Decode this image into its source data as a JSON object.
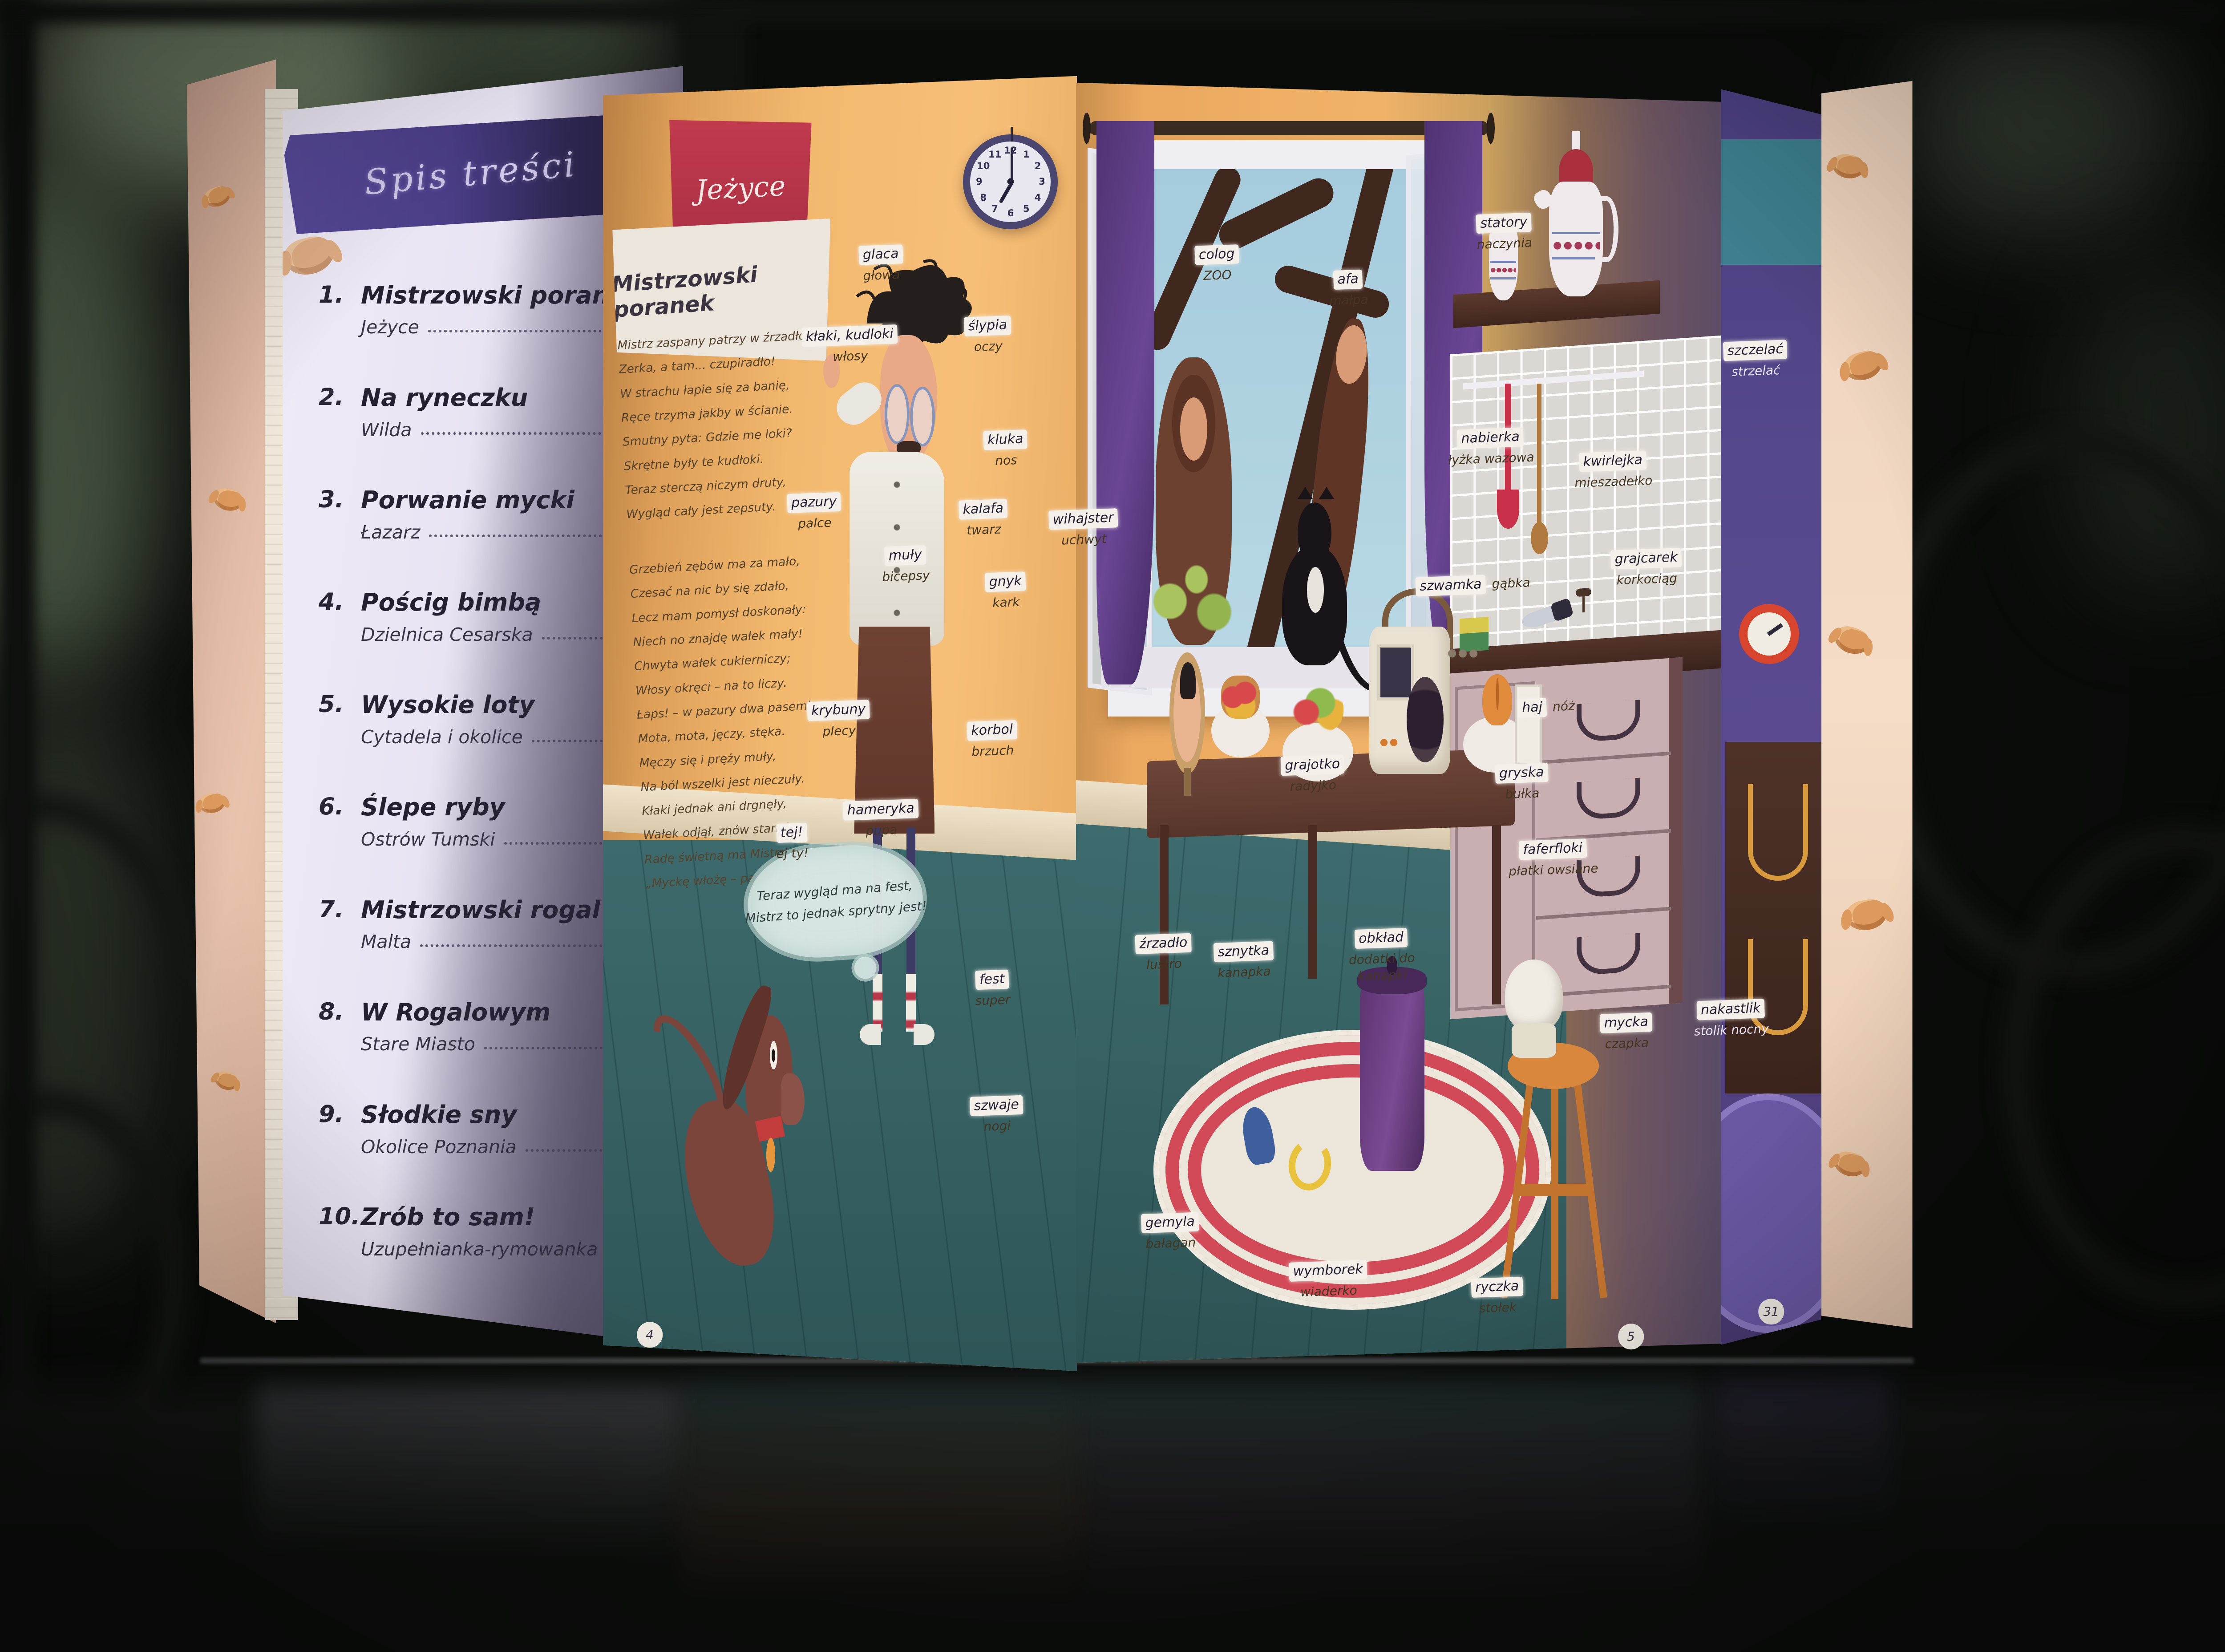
{
  "book": {
    "left_page": {
      "header": "Spis treści",
      "items": [
        {
          "num": "1.",
          "title": "Mistrzowski poranek",
          "sub": "Jeżyce"
        },
        {
          "num": "2.",
          "title": "Na ryneczku",
          "sub": "Wilda"
        },
        {
          "num": "3.",
          "title": "Porwanie mycki",
          "sub": "Łazarz"
        },
        {
          "num": "4.",
          "title": "Pościg bimbą",
          "sub": "Dzielnica Cesarska"
        },
        {
          "num": "5.",
          "title": "Wysokie loty",
          "sub": "Cytadela i okolice"
        },
        {
          "num": "6.",
          "title": "Ślepe ryby",
          "sub": "Ostrów Tumski"
        },
        {
          "num": "7.",
          "title": "Mistrzowski rogal",
          "sub": "Malta"
        },
        {
          "num": "8.",
          "title": "W Rogalowym",
          "sub": "Stare Miasto"
        },
        {
          "num": "9.",
          "title": "Słodkie sny",
          "sub": "Okolice Poznania"
        },
        {
          "num": "10.",
          "title": "Zrób to sam!",
          "sub": "Uzupełnianka-rymowanka"
        }
      ]
    },
    "middle_page": {
      "district_tab": "Jeżyce",
      "chapter_title": "Mistrzowski poranek",
      "page_number": "4",
      "poem": [
        "Mistrz zaspany patrzy w źrzadło,",
        "Zerka, a tam... czupiradło!",
        "W strachu łapie się za banię,",
        "Ręce trzyma jakby w ścianie.",
        "Smutny pyta: Gdzie me loki?",
        "Skrętne były te kudłoki.",
        "Teraz sterczą niczym druty,",
        "Wygląd cały jest zepsuty.",
        "Grzebień zębów ma za mało,",
        "Czesać na nic by się zdało,",
        "Lecz mam pomysł doskonały:",
        "Niech no znajdę wałek mały!",
        "Chwyta wałek cukierniczy;",
        "Włosy okręci – na to liczy.",
        "Łaps! – w pazury dwa pasemka,",
        "Mota, mota, jęczy, stęka.",
        "Męczy się i pręży muły,",
        "Na ból wszelki jest nieczuły.",
        "Kłaki jednak ani drgnęły,",
        "Wałek odjął, znów stanęły...",
        "Radę świetną ma Mistrz za to:",
        "„Myckę włożę – pa, tej, na to!”"
      ],
      "speech_bubble": [
        "Teraz wygląd ma na fest,",
        "Mistrz to jednak sprytny jest!"
      ],
      "labels": [
        {
          "d": "glaca",
          "s": "głowa",
          "x": 39.6,
          "y": 16.0
        },
        {
          "d": "kłaki, kudloki",
          "s": "włosy",
          "x": 38.2,
          "y": 20.9
        },
        {
          "d": "ślypia",
          "s": "oczy",
          "x": 44.4,
          "y": 20.3
        },
        {
          "d": "kluka",
          "s": "nos",
          "x": 45.2,
          "y": 27.2
        },
        {
          "d": "pazury",
          "s": "palce",
          "x": 36.6,
          "y": 31.0
        },
        {
          "d": "kalafa",
          "s": "twarz",
          "x": 44.2,
          "y": 31.4
        },
        {
          "d": "muły",
          "s": "bicepsy",
          "x": 40.7,
          "y": 34.2
        },
        {
          "d": "gnyk",
          "s": "kark",
          "x": 45.2,
          "y": 35.8
        },
        {
          "d": "krybuny",
          "s": "plecy",
          "x": 37.7,
          "y": 43.6
        },
        {
          "d": "korbol",
          "s": "brzuch",
          "x": 44.6,
          "y": 44.8
        },
        {
          "d": "hameryka",
          "s": "pupa",
          "x": 39.6,
          "y": 49.6
        },
        {
          "d": "tej!",
          "s": "ej ty!",
          "x": 35.6,
          "y": 51.0
        },
        {
          "d": "fest",
          "s": "super",
          "x": 44.6,
          "y": 59.9
        },
        {
          "d": "szwaje",
          "s": "nogi",
          "x": 44.8,
          "y": 67.5
        }
      ]
    },
    "right_page": {
      "page_number": "5",
      "zoo_sign": {
        "d": "colog",
        "s": "ZOO"
      },
      "labels": [
        {
          "d": "wihajster",
          "s": "uchwyt",
          "x": 48.7,
          "y": 32.0
        },
        {
          "d": "colog",
          "s": "ZOO",
          "x": 54.7,
          "y": 16.0
        },
        {
          "d": "afa",
          "s": "małpa",
          "x": 60.6,
          "y": 17.5
        },
        {
          "d": "statory",
          "s": "naczynia",
          "x": 67.6,
          "y": 14.1
        },
        {
          "d": "nabierka",
          "s": "łyżka wazowa",
          "x": 67.0,
          "y": 27.1
        },
        {
          "d": "kwirlejka",
          "s": "mieszadełko",
          "x": 72.5,
          "y": 28.5
        },
        {
          "d": "szwamka",
          "s": "gąbka",
          "x": 66.2,
          "y": 35.4,
          "row": true
        },
        {
          "d": "grajcarek",
          "s": "korkociąg",
          "x": 74.0,
          "y": 34.4
        },
        {
          "d": "haj",
          "s": "nóż",
          "x": 69.5,
          "y": 42.8,
          "row": true
        },
        {
          "d": "gryska",
          "s": "bułka",
          "x": 68.4,
          "y": 47.4
        },
        {
          "d": "faferfloki",
          "s": "płatki owsiane",
          "x": 69.8,
          "y": 52.0
        },
        {
          "d": "grajotko",
          "s": "radyjko",
          "x": 59.0,
          "y": 46.9
        },
        {
          "d": "źrzadło",
          "s": "lustro",
          "x": 52.3,
          "y": 57.7
        },
        {
          "d": "sznytka",
          "s": "kanapka",
          "x": 55.9,
          "y": 58.2
        },
        {
          "d": "obkład",
          "s": "dodatki do kanapki",
          "x": 62.1,
          "y": 57.9
        },
        {
          "d": "mycka",
          "s": "czapka",
          "x": 73.1,
          "y": 62.5
        },
        {
          "d": "gemyla",
          "s": "bałagan",
          "x": 52.6,
          "y": 74.6
        },
        {
          "d": "wymborek",
          "s": "wiaderko",
          "x": 59.7,
          "y": 77.5
        },
        {
          "d": "ryczka",
          "s": "stołek",
          "x": 67.3,
          "y": 78.5
        }
      ]
    },
    "next_page": {
      "page_number": "31",
      "labels": [
        {
          "d": "szczelać",
          "s": "strzelać",
          "x": 78.9,
          "y": 21.8,
          "light": true
        },
        {
          "d": "nakastlik",
          "s": "stolik nocny",
          "x": 77.8,
          "y": 61.7,
          "light": true
        }
      ]
    },
    "clock": {
      "time": "7:00",
      "numbers": [
        "12",
        "1",
        "2",
        "3",
        "4",
        "5",
        "6",
        "7",
        "8",
        "9",
        "10",
        "11"
      ]
    }
  },
  "colors": {
    "banner_purple": "#4a3d86",
    "tab_red": "#c13a4e",
    "wall_orange": "#f2b86e",
    "floor_teal": "#355e60",
    "label_bg": "#f4f0e9",
    "next_page_purple": "#56488c"
  }
}
